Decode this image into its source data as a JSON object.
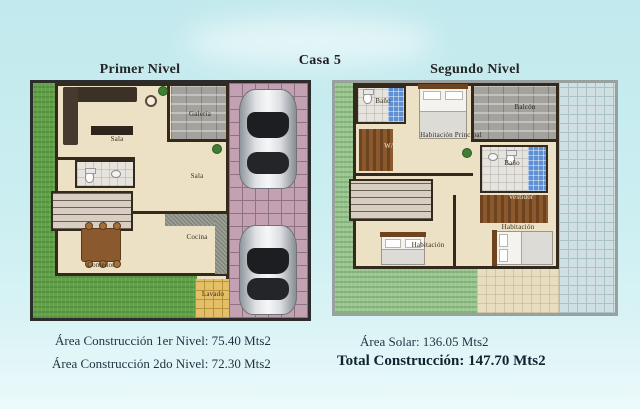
{
  "page_title": "Casa 5",
  "plans": {
    "first": {
      "title": "Primer Nivel",
      "rooms": {
        "sala_sofa": "Sala",
        "galeria": "Galería",
        "sala_center": "Sala",
        "cocina": "Cocina",
        "comedor": "Comedor",
        "lavado": "Lavado"
      }
    },
    "second": {
      "title": "Segundo Nivel",
      "rooms": {
        "bano_top": "Baño",
        "habitacion_principal": "Habitación Principal",
        "balcon": "Balcón",
        "wc": "W/C",
        "bano_mid": "Baño",
        "vestidor": "Vestidor",
        "habitacion_left": "Habitación",
        "habitacion_right": "Habitación"
      }
    }
  },
  "summary": {
    "construction_level1": "Área Construcción 1er Nivel: 75.40 Mts2",
    "construction_level2": "Área Construcción 2do Nivel: 72.30 Mts2",
    "solar": "Área Solar: 136.05 Mts2",
    "total": "Total Construcción: 147.70 Mts2"
  },
  "colors": {
    "background": "#c9edf0",
    "grass_first_level": "#63a24b",
    "grass_second_level": "#9cc793",
    "driveway_tile": "#c3a1b3",
    "patio_tile": "#cfdfe2",
    "laundry_tile": "#e3bf68",
    "bath_tile_blue": "#5e90d2",
    "floor": "#ece1c4",
    "wall": "#33291d",
    "text": "#1d3440"
  }
}
